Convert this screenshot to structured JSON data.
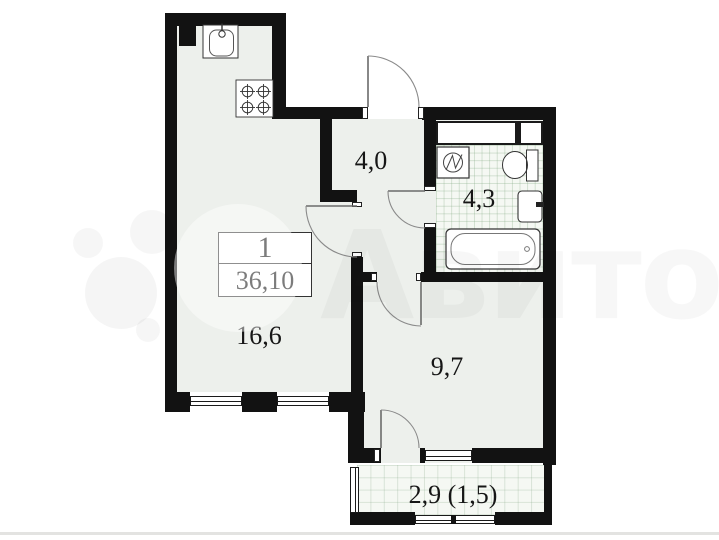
{
  "floorplan": {
    "unit_info": {
      "rooms_count": "1",
      "total_area": "36,10"
    },
    "room_labels": {
      "hallway": "4,0",
      "bathroom": "4,3",
      "kitchen_living_room": "16,6",
      "room": "9,7",
      "balcony": "2,9 (1,5)"
    },
    "watermark_text": "Авито",
    "colors": {
      "wall": "#121212",
      "room_fill": "#edf0ec",
      "tile_fill": "#f5f8f3",
      "door_arc": "#8a8a8a",
      "bottom_rule": "#e3e3e1"
    },
    "fixtures": [
      "kitchen-sink",
      "stove",
      "washing-machine",
      "toilet",
      "bathroom-sink",
      "bathtub"
    ]
  }
}
